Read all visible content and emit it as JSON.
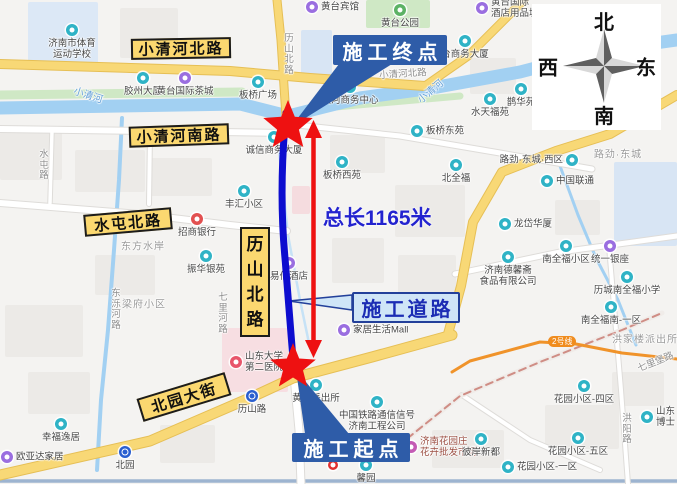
{
  "annotations": {
    "end_point": "施工终点",
    "start_point": "施工起点",
    "construction_road": "施工道路",
    "total_length": "总长1165米"
  },
  "compass": {
    "north": "北",
    "south": "南",
    "west": "西",
    "east": "东"
  },
  "metro_badge": {
    "text": "2号线"
  },
  "colors": {
    "callout_solid": "#2e5ca8",
    "callout_light_bg": "#cfe5f7",
    "callout_light_border": "#23409a",
    "callout_light_text": "#1b2cb4",
    "length_text": "#2323cf",
    "construction_line": "#0d0dcf",
    "arrow_red": "#ee1111",
    "sign_bg": "#fbd870",
    "road_yellow": "#f8d876",
    "road_yellow_edge": "#e6bf55",
    "river_blue": "#a2d0f2",
    "park_green": "#cfe8c5",
    "metro_orange": "#f0932a",
    "railway_red": "#cf8d85",
    "poi_teal": "#2fb3c6",
    "poi_purple": "#9a6ee0"
  },
  "road_signs": [
    {
      "text": "小清河北路",
      "x": 181,
      "y": 48,
      "w": 100,
      "h": 21,
      "rotate": -1,
      "vertical": false
    },
    {
      "text": "小清河南路",
      "x": 179,
      "y": 135,
      "w": 100,
      "h": 21,
      "rotate": -2,
      "vertical": false
    },
    {
      "text": "水屯北路",
      "x": 128,
      "y": 222,
      "w": 88,
      "h": 22,
      "rotate": -5,
      "vertical": false
    },
    {
      "text": "北园大街",
      "x": 184,
      "y": 397,
      "w": 92,
      "h": 24,
      "rotate": -17,
      "vertical": false
    },
    {
      "text": "历山北路",
      "x": 255,
      "y": 282,
      "w": 30,
      "h": 110,
      "rotate": 0,
      "vertical": true
    }
  ],
  "street_labels": [
    {
      "text": "历山北路",
      "x": 289,
      "y": 55,
      "vertical": true
    },
    {
      "text": "小清河北路",
      "x": 403,
      "y": 75,
      "rotate": -4
    },
    {
      "text": "水屯路",
      "x": 44,
      "y": 166,
      "vertical": true
    },
    {
      "text": "东泺河路",
      "x": 116,
      "y": 310,
      "vertical": true
    },
    {
      "text": "七里河路",
      "x": 223,
      "y": 314,
      "vertical": true
    },
    {
      "text": "洪阳路",
      "x": 627,
      "y": 430,
      "vertical": true
    },
    {
      "text": "七里堡路",
      "x": 656,
      "y": 363,
      "rotate": -22
    },
    {
      "text": "小清河",
      "x": 88,
      "y": 96,
      "rotate": 18,
      "kind": "river"
    },
    {
      "text": "小清河",
      "x": 431,
      "y": 92,
      "rotate": -40,
      "kind": "river"
    },
    {
      "text": "路劲·东城",
      "x": 618,
      "y": 155,
      "kind": "area"
    },
    {
      "text": "梁府小区",
      "x": 144,
      "y": 305,
      "kind": "area"
    },
    {
      "text": "东方水岸",
      "x": 143,
      "y": 247,
      "kind": "area"
    },
    {
      "text": "洪家楼派出所",
      "x": 645,
      "y": 340,
      "kind": "area"
    }
  ],
  "pois": [
    {
      "lines": [
        "济南市体育",
        "运动学校"
      ],
      "icon": "teal",
      "x": 72,
      "y": 30,
      "pos": "below"
    },
    {
      "lines": [
        "胶州大厦"
      ],
      "icon": "teal",
      "x": 143,
      "y": 78,
      "pos": "below"
    },
    {
      "lines": [
        "黄台国际茶城"
      ],
      "icon": "purple",
      "x": 185,
      "y": 78,
      "pos": "below"
    },
    {
      "lines": [
        "黄台宾馆"
      ],
      "icon": "purple",
      "x": 312,
      "y": 7,
      "pos": "right"
    },
    {
      "lines": [
        "黄台公园"
      ],
      "icon": "green",
      "x": 400,
      "y": 10,
      "pos": "below"
    },
    {
      "lines": [
        "黄台国际",
        "酒店用品城"
      ],
      "icon": "purple",
      "x": 482,
      "y": 8,
      "pos": "right"
    },
    {
      "lines": [
        "台商务大厦"
      ],
      "icon": "teal",
      "x": 465,
      "y": 41,
      "pos": "below"
    },
    {
      "lines": [
        "板桥广场"
      ],
      "icon": "teal",
      "x": 258,
      "y": 82,
      "pos": "below"
    },
    {
      "lines": [
        "滨河商务中心"
      ],
      "icon": "teal",
      "x": 350,
      "y": 87,
      "pos": "below"
    },
    {
      "lines": [
        "板桥东苑"
      ],
      "icon": "teal",
      "x": 417,
      "y": 131,
      "pos": "right"
    },
    {
      "lines": [
        "鹊华苑"
      ],
      "icon": "teal",
      "x": 521,
      "y": 89,
      "pos": "below"
    },
    {
      "lines": [
        "水天福苑"
      ],
      "icon": "teal",
      "x": 490,
      "y": 99,
      "pos": "below"
    },
    {
      "lines": [
        "诚信商务大厦"
      ],
      "icon": "teal",
      "x": 274,
      "y": 137,
      "pos": "below"
    },
    {
      "lines": [
        "板桥西苑"
      ],
      "icon": "teal",
      "x": 342,
      "y": 162,
      "pos": "below"
    },
    {
      "lines": [
        "北全福"
      ],
      "icon": "teal",
      "x": 456,
      "y": 165,
      "pos": "below"
    },
    {
      "lines": [
        "丰汇小区"
      ],
      "icon": "teal",
      "x": 244,
      "y": 191,
      "pos": "below"
    },
    {
      "lines": [
        "招商银行"
      ],
      "icon": "bank",
      "x": 197,
      "y": 219,
      "pos": "below"
    },
    {
      "lines": [
        "振华银苑"
      ],
      "icon": "teal",
      "x": 206,
      "y": 256,
      "pos": "below"
    },
    {
      "lines": [
        "易佰酒店"
      ],
      "icon": "purple",
      "x": 289,
      "y": 263,
      "pos": "below"
    },
    {
      "lines": [
        "路劲·东城·西区"
      ],
      "icon": "teal",
      "x": 572,
      "y": 160,
      "pos": "left"
    },
    {
      "lines": [
        "中国联通"
      ],
      "icon": "teal",
      "x": 547,
      "y": 181,
      "pos": "right"
    },
    {
      "lines": [
        "龙岱华厦"
      ],
      "icon": "teal",
      "x": 505,
      "y": 224,
      "pos": "right"
    },
    {
      "lines": [
        "南全福小区"
      ],
      "icon": "teal",
      "x": 566,
      "y": 246,
      "pos": "below"
    },
    {
      "lines": [
        "统一银座"
      ],
      "icon": "purple",
      "x": 610,
      "y": 246,
      "pos": "below"
    },
    {
      "lines": [
        "济南德馨斋",
        "食品有限公司"
      ],
      "icon": "teal",
      "x": 508,
      "y": 257,
      "pos": "below"
    },
    {
      "lines": [
        "历城南全福小学"
      ],
      "icon": "teal",
      "x": 627,
      "y": 277,
      "pos": "below"
    },
    {
      "lines": [
        "南全福南-一区"
      ],
      "icon": "teal",
      "x": 611,
      "y": 307,
      "pos": "below"
    },
    {
      "lines": [
        "家居生活Mall"
      ],
      "icon": "purple",
      "x": 344,
      "y": 330,
      "pos": "right"
    },
    {
      "lines": [
        "山东大学",
        "第二医院"
      ],
      "icon": "hospital",
      "x": 236,
      "y": 362,
      "pos": "right"
    },
    {
      "lines": [
        "黄台派出所"
      ],
      "icon": "teal",
      "x": 316,
      "y": 385,
      "pos": "below"
    },
    {
      "lines": [
        "历山路"
      ],
      "icon": "metro",
      "x": 252,
      "y": 396,
      "pos": "below"
    },
    {
      "lines": [
        "中国铁路通信信号",
        "济南工程公司"
      ],
      "icon": "teal",
      "x": 377,
      "y": 402,
      "pos": "below"
    },
    {
      "lines": [
        "济南花园庄",
        "花卉批发市场"
      ],
      "icon": "market",
      "x": 411,
      "y": 447,
      "pos": "right",
      "color": "#9c4f43"
    },
    {
      "lines": [
        "馨园"
      ],
      "icon": "teal",
      "x": 366,
      "y": 465,
      "pos": "below"
    },
    {
      "lines": [
        "彼岸新都"
      ],
      "icon": "teal",
      "x": 481,
      "y": 439,
      "pos": "below"
    },
    {
      "lines": [
        "花园小区-四区"
      ],
      "icon": "teal",
      "x": 584,
      "y": 386,
      "pos": "below"
    },
    {
      "lines": [
        "花园小区-五区"
      ],
      "icon": "teal",
      "x": 578,
      "y": 438,
      "pos": "below"
    },
    {
      "lines": [
        "花园小区-一区"
      ],
      "icon": "teal",
      "x": 508,
      "y": 467,
      "pos": "right"
    },
    {
      "lines": [
        "北园"
      ],
      "icon": "metro",
      "x": 125,
      "y": 452,
      "pos": "below"
    },
    {
      "lines": [
        "幸福逸居"
      ],
      "icon": "teal",
      "x": 61,
      "y": 424,
      "pos": "below"
    },
    {
      "lines": [
        "欧亚达家居"
      ],
      "icon": "purple",
      "x": 7,
      "y": 457,
      "pos": "right"
    },
    {
      "lines": [
        "山东",
        "博士"
      ],
      "icon": "teal",
      "x": 647,
      "y": 417,
      "pos": "right"
    },
    {
      "lines": [],
      "icon": "pin",
      "x": 334,
      "y": 466,
      "pos": "below"
    }
  ],
  "layers": {
    "blocks": [
      {
        "x": 28,
        "y": 2,
        "w": 70,
        "h": 62,
        "c": "#dce8f6"
      },
      {
        "x": 120,
        "y": 8,
        "w": 58,
        "h": 50,
        "c": "#eceae7"
      },
      {
        "x": 301,
        "y": 30,
        "w": 31,
        "h": 48,
        "c": "#d8e5f4"
      },
      {
        "x": 614,
        "y": 162,
        "w": 63,
        "h": 84,
        "c": "#d8e5f4"
      },
      {
        "x": 222,
        "y": 328,
        "w": 66,
        "h": 64,
        "c": "#f7dee2"
      },
      {
        "x": 292,
        "y": 186,
        "w": 18,
        "h": 28,
        "c": "#f5dcdf"
      },
      {
        "x": 0,
        "y": 132,
        "w": 62,
        "h": 48,
        "c": "#eceae7"
      },
      {
        "x": 75,
        "y": 150,
        "w": 70,
        "h": 42,
        "c": "#eceae7"
      },
      {
        "x": 150,
        "y": 158,
        "w": 62,
        "h": 38,
        "c": "#eceae7"
      },
      {
        "x": 330,
        "y": 135,
        "w": 55,
        "h": 38,
        "c": "#eceae7"
      },
      {
        "x": 395,
        "y": 185,
        "w": 70,
        "h": 52,
        "c": "#eceae7"
      },
      {
        "x": 470,
        "y": 58,
        "w": 46,
        "h": 36,
        "c": "#eceae7"
      },
      {
        "x": 332,
        "y": 238,
        "w": 52,
        "h": 45,
        "c": "#eceae7"
      },
      {
        "x": 398,
        "y": 255,
        "w": 58,
        "h": 40,
        "c": "#eceae7"
      },
      {
        "x": 5,
        "y": 305,
        "w": 78,
        "h": 52,
        "c": "#eceae7"
      },
      {
        "x": 28,
        "y": 372,
        "w": 62,
        "h": 42,
        "c": "#eceae7"
      },
      {
        "x": 432,
        "y": 430,
        "w": 72,
        "h": 38,
        "c": "#eceae7"
      },
      {
        "x": 545,
        "y": 405,
        "w": 74,
        "h": 44,
        "c": "#eceae7"
      },
      {
        "x": 612,
        "y": 372,
        "w": 52,
        "h": 34,
        "c": "#eceae7"
      },
      {
        "x": 95,
        "y": 255,
        "w": 60,
        "h": 40,
        "c": "#eceae7"
      },
      {
        "x": 555,
        "y": 200,
        "w": 45,
        "h": 35,
        "c": "#eceae7"
      },
      {
        "x": 160,
        "y": 425,
        "w": 55,
        "h": 38,
        "c": "#eceae7"
      },
      {
        "x": 366,
        "y": 0,
        "w": 64,
        "h": 28,
        "c": "#cfe8c5"
      }
    ],
    "green": [
      {
        "d": "M0,95 L242,92",
        "w": 9
      },
      {
        "d": "M302,110 L460,96",
        "w": 7
      }
    ],
    "water": [
      {
        "d": "M0,108 L240,104 L288,116 L360,98 L432,88 L520,72 L605,50 L677,40",
        "w": 13
      },
      {
        "d": "M122,118 L119,180 L114,250 L108,330 L101,400 L97,470",
        "w": 4
      },
      {
        "d": "M560,166 L578,215 L596,258 L618,300 L636,345",
        "w": 3
      },
      {
        "d": "M279,150 L288,235 L300,300 L310,348",
        "w": 2.5,
        "c": "#c6e2f6"
      },
      {
        "d": "M0,481 L677,481",
        "w": 3.5,
        "c": "#9db4d0"
      }
    ],
    "roads_white": [
      {
        "d": "M0,129 L150,131 L287,133",
        "w": 6
      },
      {
        "d": "M0,203 L140,214 L230,225 L287,231",
        "w": 6
      },
      {
        "d": "M294,376 L299,430 L301,484",
        "w": 7
      },
      {
        "d": "M288,124 L400,136 L500,153 L592,169",
        "w": 5
      },
      {
        "d": "M455,274 L560,252 L677,236",
        "w": 5
      },
      {
        "d": "M609,246 L621,390 L628,484",
        "w": 4
      },
      {
        "d": "M150,133 L149,204",
        "w": 4
      },
      {
        "d": "M52,131 L50,203",
        "w": 3.5
      },
      {
        "d": "M462,395 L530,440 L600,470",
        "w": 4
      }
    ],
    "roads_yellow": [
      {
        "d": "M0,64 L230,71 L310,78 L425,86",
        "w": 8
      },
      {
        "d": "M425,86 L468,56 L524,0",
        "w": 7
      },
      {
        "d": "M277,0 L281,40 L286,117",
        "w": 7
      },
      {
        "d": "M0,475 L150,441 L252,397 L293,378 L372,357 L452,335",
        "w": 9
      },
      {
        "d": "M677,95 L610,134 L556,151 L502,172 L473,222 L461,286 L448,334",
        "w": 8
      }
    ],
    "railway": {
      "d": "M398,446 L460,396 L540,362 L622,330 L662,313"
    },
    "metro": {
      "d": "M452,372 L470,361 L540,342 L576,344 L622,353 L677,359"
    },
    "construction_line": {
      "d": "M286,113 C281,165 281,215 285,258 C288,298 291,332 294,372"
    },
    "arrow": {
      "x": 313.5,
      "shaft_y1": 136,
      "shaft_y2": 342,
      "tip_top": 120,
      "tip_bottom": 358,
      "half_width": 8.5,
      "head_len": 18
    },
    "stars": [
      {
        "x": 288,
        "y": 126,
        "R": 26,
        "r": 11.5
      },
      {
        "x": 293,
        "y": 367,
        "R": 24,
        "r": 10.5
      }
    ],
    "tails": [
      {
        "points": "339,64 392,64 291,127",
        "type": "solid"
      },
      {
        "points": "305,434 349,434 296,370",
        "type": "solid"
      },
      {
        "points": "352,295 352,310 289,301",
        "type": "light"
      }
    ]
  }
}
